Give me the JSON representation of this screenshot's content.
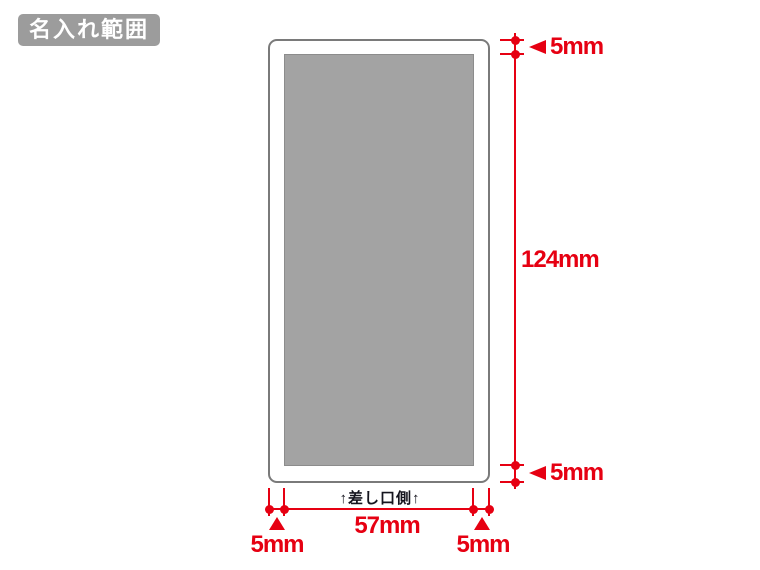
{
  "badge": {
    "label": "名入れ範囲"
  },
  "diagram": {
    "insert_side_label": "↑差し口側↑",
    "dimensions": {
      "top_margin": "5mm",
      "print_height": "124mm",
      "bottom_margin": "5mm",
      "left_margin": "5mm",
      "print_width": "57mm",
      "right_margin": "5mm"
    },
    "colors": {
      "dimension_red": "#e60012",
      "print_area_fill": "#a3a3a3",
      "outline_stroke": "#7a7a7a",
      "badge_background": "#9c9c9c"
    }
  }
}
